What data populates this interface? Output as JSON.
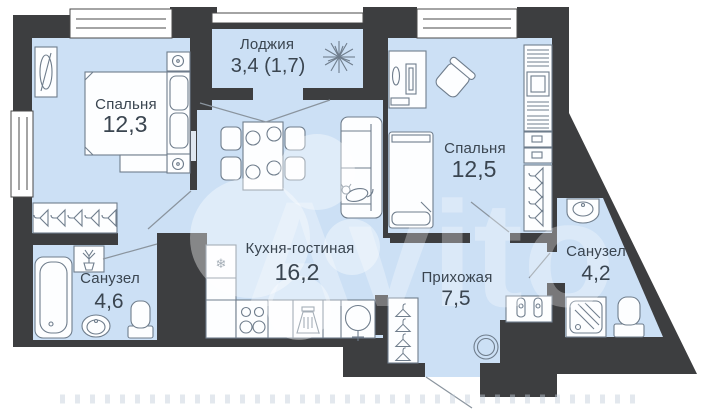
{
  "plan": {
    "type": "apartment-floor-plan",
    "colors": {
      "background": "#ffffff",
      "wall": "#3d3e40",
      "floor": "#cce0f5",
      "furniture_stroke": "#6f7d8c",
      "furniture_fill": "#fdfeff",
      "label": "#3a4550",
      "door_line": "#8a949e",
      "watermark": "#ffffff"
    },
    "rooms": [
      {
        "id": "loggia",
        "name": "Лоджия",
        "area": "3,4 (1,7)"
      },
      {
        "id": "bedroom-1",
        "name": "Спальня",
        "area": "12,3"
      },
      {
        "id": "bedroom-2",
        "name": "Спальня",
        "area": "12,5"
      },
      {
        "id": "kitchen-living",
        "name": "Кухня-гостиная",
        "area": "16,2"
      },
      {
        "id": "hallway",
        "name": "Прихожая",
        "area": "7,5"
      },
      {
        "id": "bathroom-1",
        "name": "Санузел",
        "area": "4,6"
      },
      {
        "id": "bathroom-2",
        "name": "Санузел",
        "area": "4,2"
      }
    ],
    "icons": {
      "fridge_glyph": "❄"
    },
    "watermark": {
      "text": "Avito"
    }
  }
}
